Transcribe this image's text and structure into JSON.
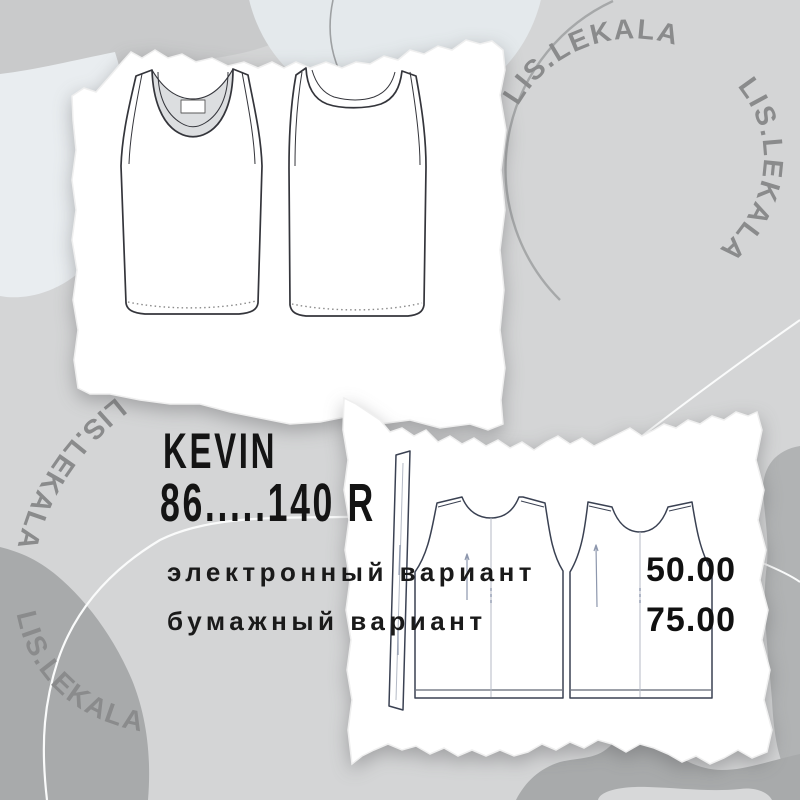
{
  "brand": {
    "watermark": "LIS.LEKALA"
  },
  "product": {
    "title": "KEVIN",
    "size_range": "86.....140 R",
    "options": [
      {
        "label": "электронный вариант",
        "price": "50.00"
      },
      {
        "label": "бумажный вариант",
        "price": "75.00"
      }
    ]
  },
  "illustrations": {
    "top_panel": "tank top technical flat - front and back view",
    "bottom_panel": "sewing pattern pieces - binding strip, front and back"
  },
  "colors": {
    "background": "#d4d5d6",
    "paper": "#ffffff",
    "text": "#161616",
    "watermark": "#8a8b8c",
    "dark_blob": "#a8aaab",
    "light_band": "#e9edf0"
  }
}
